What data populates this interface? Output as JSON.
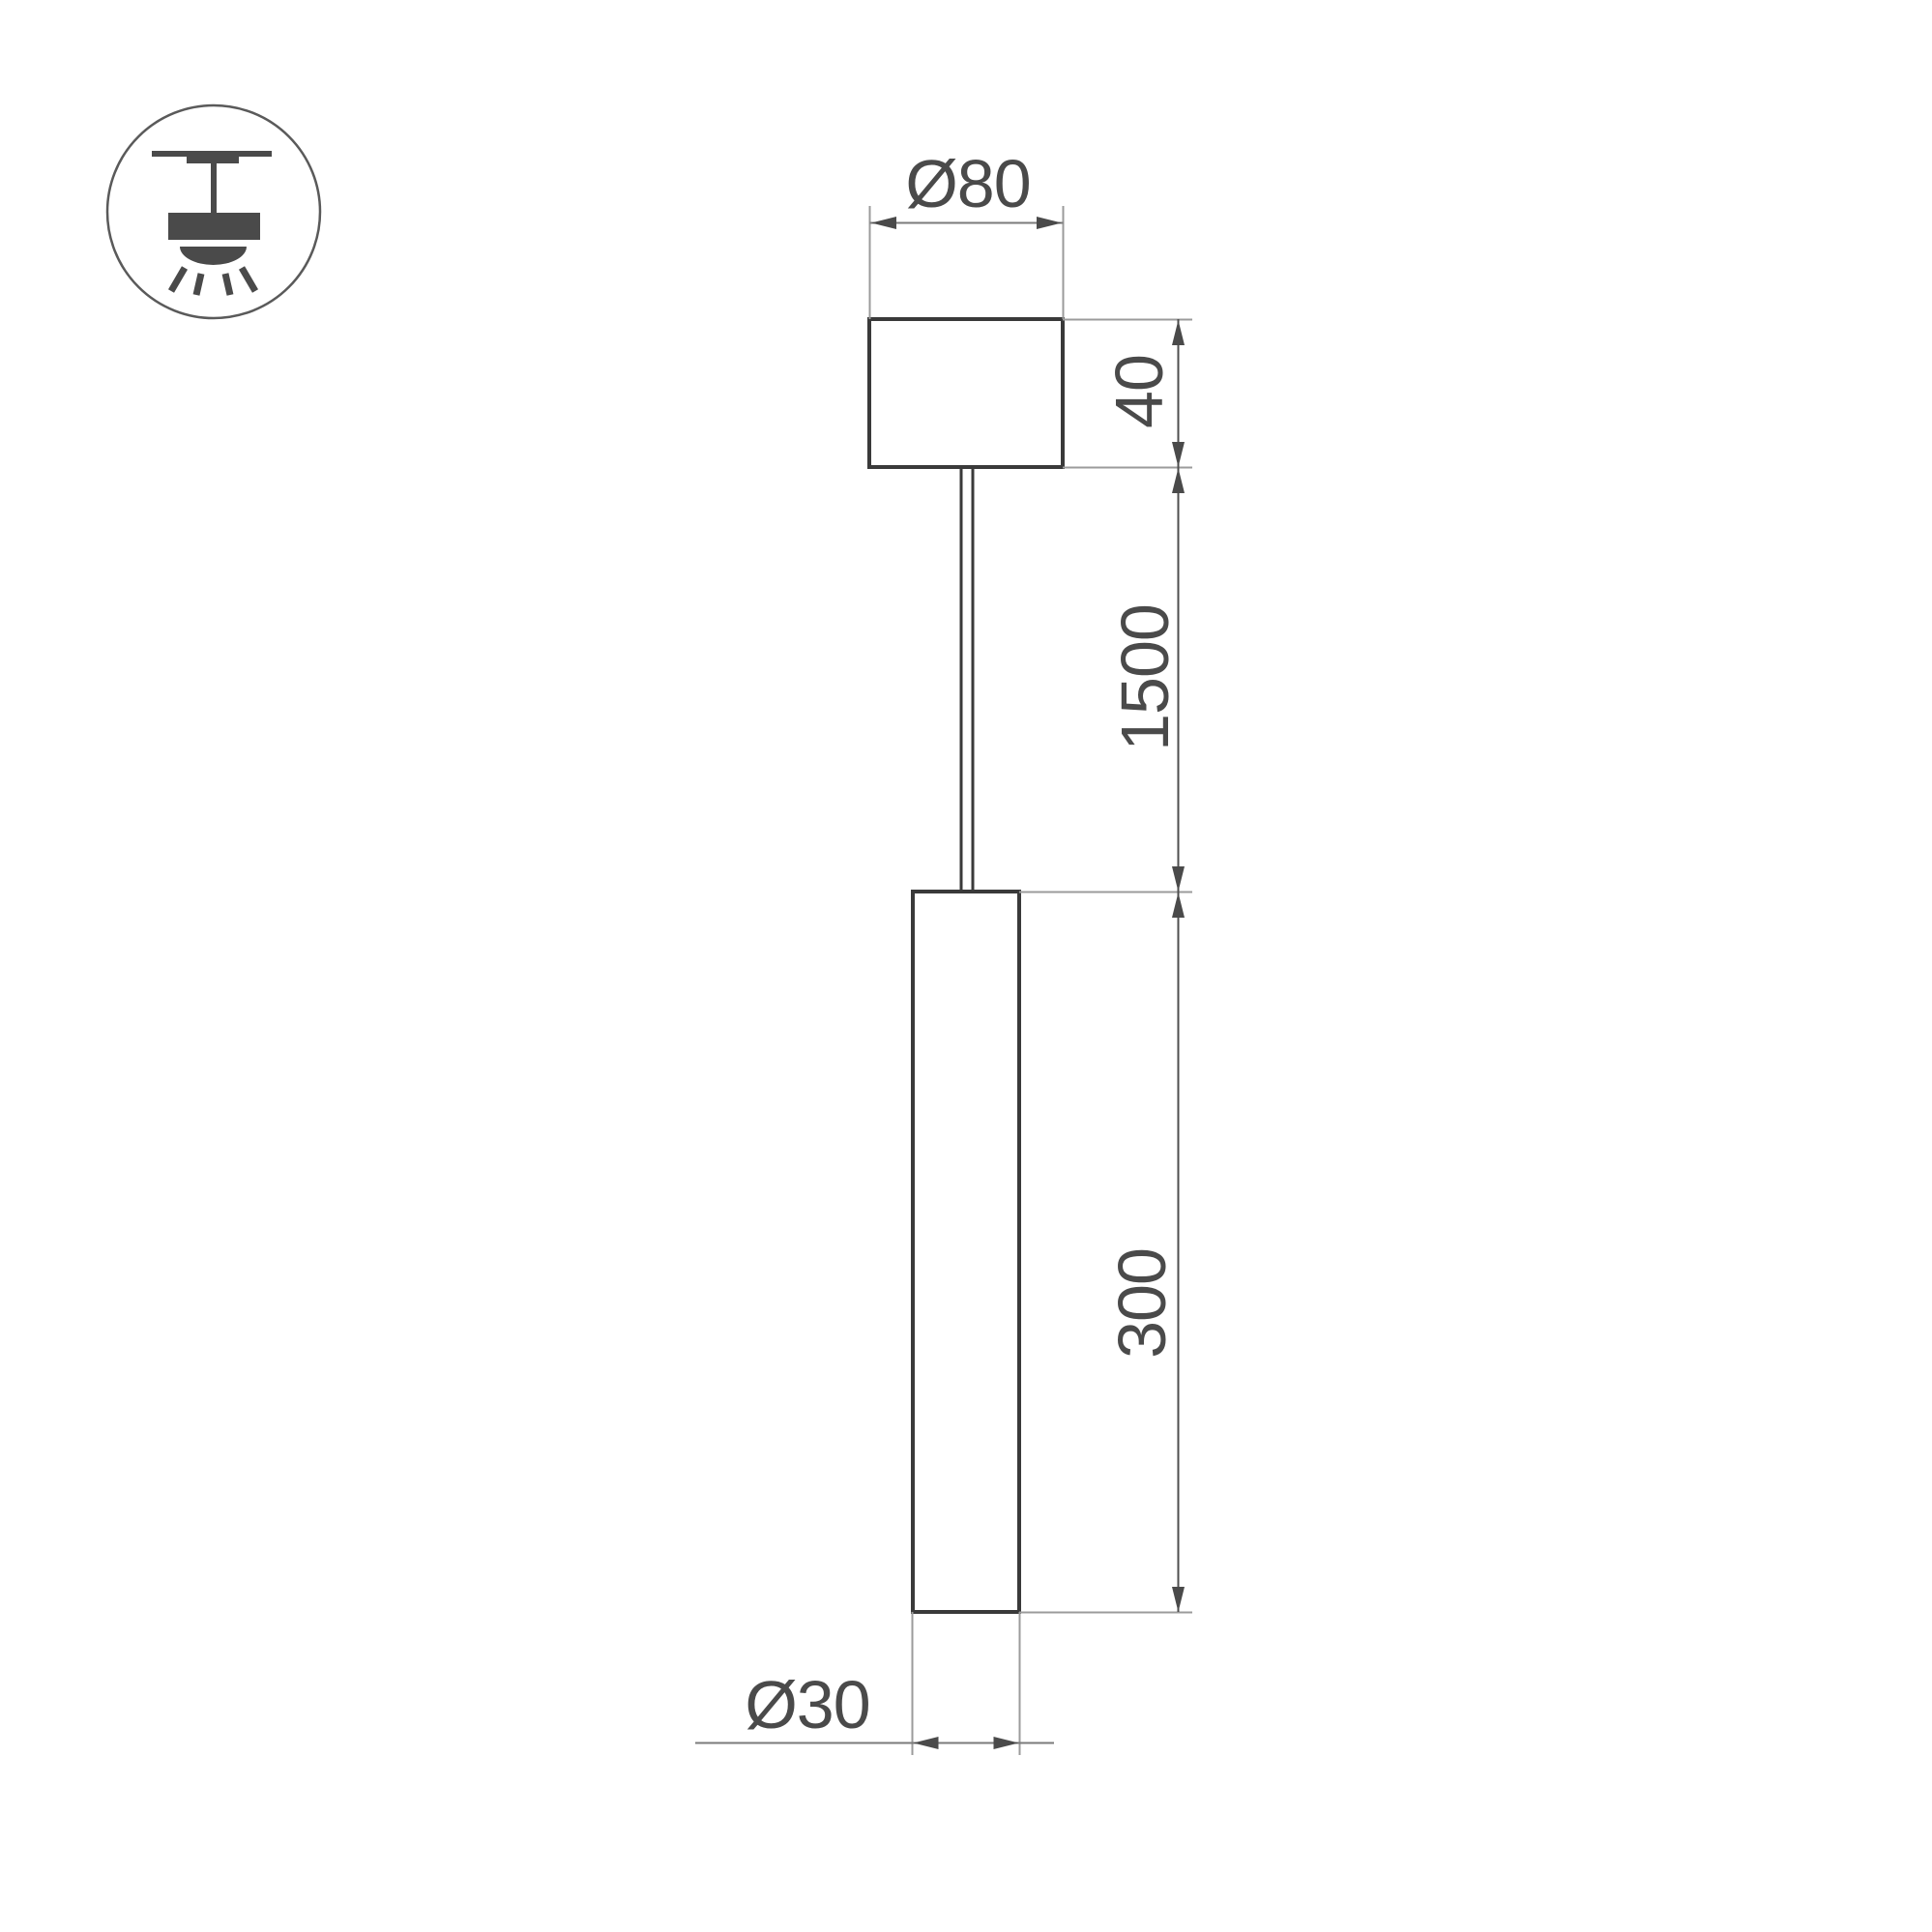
{
  "icon_legend": {
    "type": "pendant-ceiling-light-symbol"
  },
  "drawing": {
    "labels": {
      "canopy_diameter": "Ø80",
      "canopy_height": "40",
      "suspension_length": "1500",
      "tube_length": "300",
      "tube_diameter": "Ø30"
    },
    "colors": {
      "object_line": "#3a3a3a",
      "dim_line": "#7b7b7b",
      "dim_line_dark": "#4f4f4f",
      "ext_line": "#9b9b9b",
      "text_color": "#4a4a4a",
      "icon_fill": "#4a4a4a",
      "icon_circle": "#5a5a5a",
      "background": "#ffffff"
    }
  }
}
